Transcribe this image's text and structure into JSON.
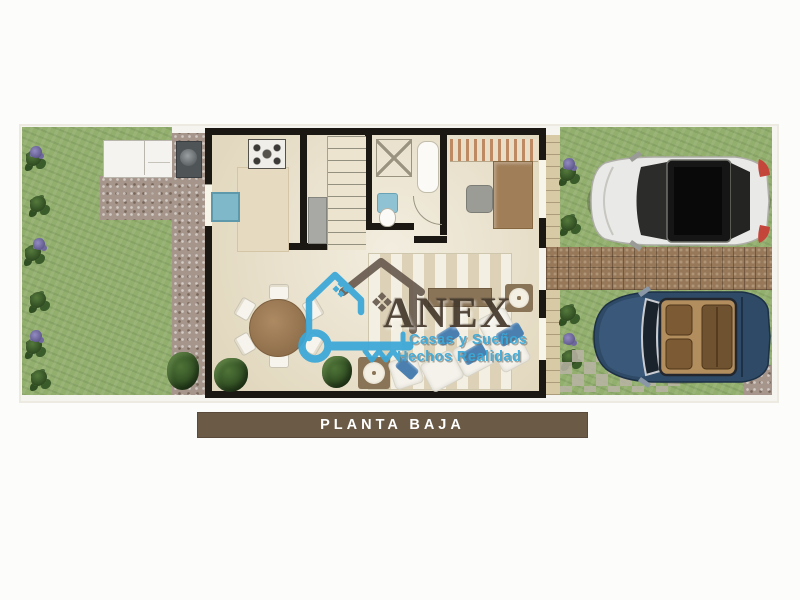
{
  "plan_label": {
    "text": "PLANTA BAJA"
  },
  "watermark": {
    "brand": "ANEX",
    "tagline1": "Casas y Sueños",
    "tagline2": "Hechos Realidad"
  },
  "colors": {
    "page-bg": "#fcfcfa",
    "bar-bg": "#6b5a45",
    "bar-text": "#ffffff",
    "accent-blue": "#3aa8d8",
    "brand-brown": "#463a2e",
    "grass": "#93af6e",
    "floor": "#ece4cf",
    "wall": "#1b1713",
    "gravel": "#a5958a",
    "tile-band": "#97795a",
    "path": "#d9caa6",
    "counter": "#e6dbc1",
    "sofa-blue": "#4a7fb0",
    "table-wood": "#a07e58",
    "white-car": "#e9e9e7",
    "blue-car": "#2e4a66",
    "sink-blue": "#7fb9c9"
  },
  "scene": {
    "areas": [
      "garden",
      "ground-floor-plan",
      "driveway"
    ],
    "features": [
      "lawn",
      "shrubs-with-purple-flowers",
      "outdoor-counter",
      "bbq-grill",
      "gravel-path",
      "kitchen-stove",
      "kitchen-island",
      "kitchen-sink",
      "refrigerator",
      "staircase",
      "shower",
      "bathtub",
      "toilet",
      "pergola",
      "desk",
      "office-chair",
      "dining-table",
      "dining-chairs",
      "area-rug",
      "sectional-sofa",
      "accent-pillows",
      "side-tables",
      "media-console",
      "potted-shrubs",
      "entry-path",
      "paved-driveway-band",
      "stepping-tiles",
      "white-suv",
      "blue-convertible"
    ]
  }
}
